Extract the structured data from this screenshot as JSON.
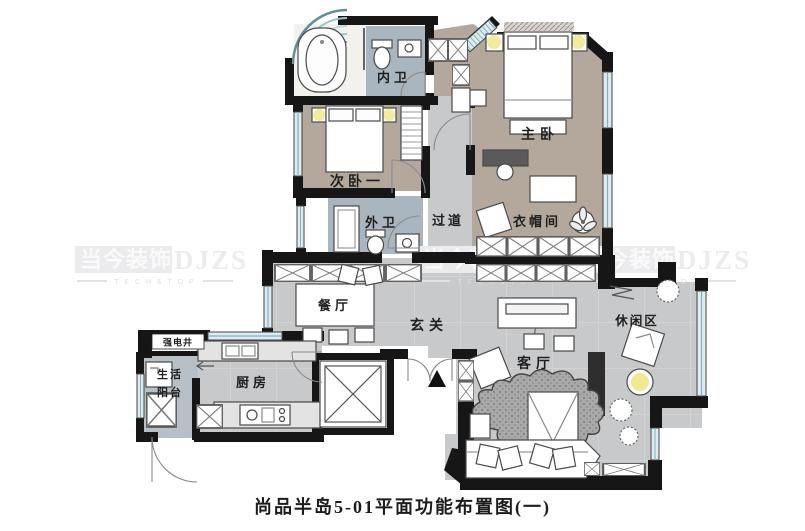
{
  "doc": {
    "title": "尚品半岛5-01平面功能布置图(一)"
  },
  "watermark": {
    "brand_cn": "当今装饰",
    "brand_en": "DJZS",
    "tagline": "T E C H & T O P"
  },
  "rooms": {
    "inner_bath": "内卫",
    "master_bedroom": "主卧",
    "second_bedroom": "次卧一",
    "outer_bath": "外卫",
    "corridor": "过道",
    "cloakroom": "衣帽间",
    "dining": "餐厅",
    "foyer": "玄关",
    "leisure": "休闲区",
    "living": "客厅",
    "kitchen": "厨房",
    "balcony_l1": "生活",
    "balcony_l2": "阳台",
    "utility_shaft": "强电井"
  },
  "colors": {
    "wall": "#161616",
    "bedroom_floor": "#b4a89c",
    "hall_floor": "#c7c9ca",
    "bath_floor": "#a9b6c0",
    "balcony_floor": "#b7c0c6",
    "window_glass": "#ddecf1",
    "lamp_yellow": "#f0e98f",
    "watermark_gray": "#ececee"
  }
}
